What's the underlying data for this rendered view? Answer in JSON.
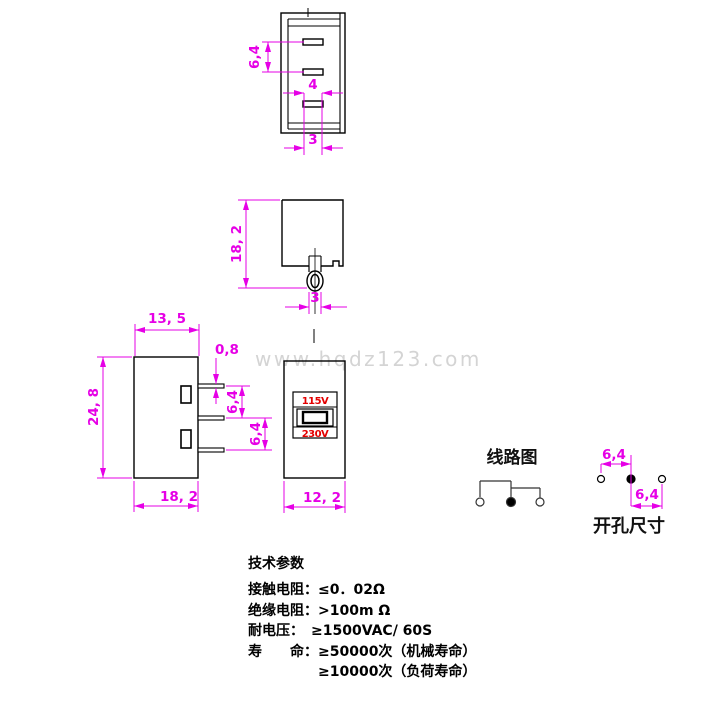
{
  "watermark": "www.hqdz123.com",
  "colors": {
    "dimension": "#e600e6",
    "voltage_red": "#e30000",
    "line_black": "#000000",
    "watermark_gray": "#d4d4d4"
  },
  "views": {
    "top_view": {
      "dim_slot_spacing": "6,4",
      "dim_slot_length": "4",
      "dim_pin_pitch": "3"
    },
    "side_view": {
      "dim_height": "18, 2",
      "dim_terminal_width": "3"
    },
    "front_view": {
      "dim_top_width": "13, 5",
      "dim_height": "24, 8",
      "dim_bottom_width": "18, 2",
      "dim_pin_thickness": "0,8",
      "dim_pin_spacing_1": "6,4",
      "dim_pin_spacing_2": "6,4"
    },
    "panel_view": {
      "label_115v": "115V",
      "label_230v": "230V",
      "dim_width": "12, 2"
    },
    "circuit": {
      "title": "线路图"
    },
    "holes": {
      "title": "开孔尺寸",
      "dim_spacing_1": "6,4",
      "dim_spacing_2": "6,4"
    }
  },
  "specs": {
    "title": "技术参数",
    "rows": [
      "接触电阻：≤0．02Ω",
      "绝缘电阻：>100m Ω",
      "耐电压：　≥1500VAC/ 60S",
      "寿　　命：≥50000次（机械寿命）",
      "　　　　　≥10000次（负荷寿命）"
    ]
  }
}
